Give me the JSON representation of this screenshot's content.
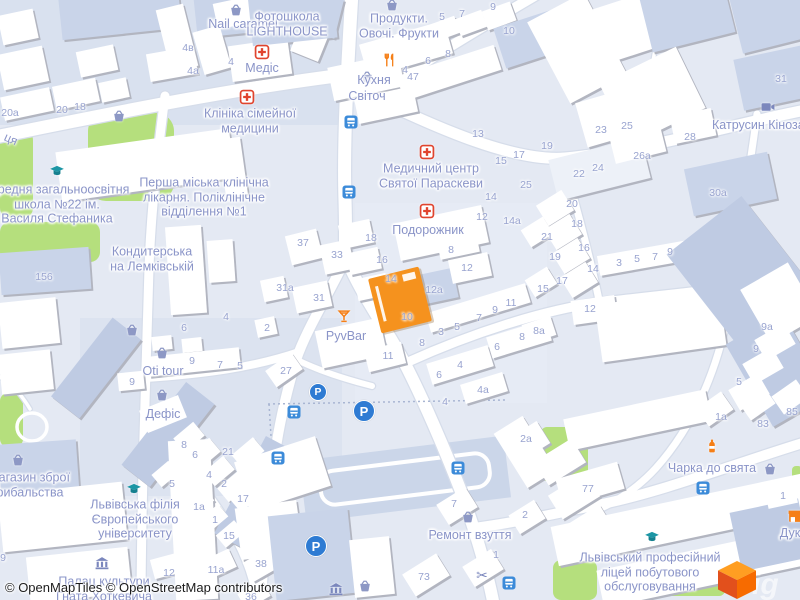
{
  "map": {
    "attribution": "© OpenMapTiles © OpenStreetMap contributors",
    "watermark_fragment": "ig",
    "logo": {
      "name": "MapTiler cube"
    },
    "parking_glyph": "P",
    "colors": {
      "background": "#E4E9F3",
      "road": "#FFFFFF",
      "park": "#B5DF7D",
      "building_white": "#FFFFFF",
      "building_blue": "#C9D4E9",
      "highlight_building": "#F5921E",
      "poi_label": "#8A94C8",
      "house_number": "#98A3CF",
      "medical_red": "#E0442E",
      "amenity_orange": "#F57F17",
      "education_teal": "#1C96A5",
      "transit_blue": "#3C8BD9",
      "parking_blue": "#2E7BD3"
    },
    "poi_labels": [
      {
        "text": "Nail caramel",
        "x": 243,
        "y": 24
      },
      {
        "text": "Фотошкола\nLIGHTHOUSE",
        "x": 287,
        "y": 24
      },
      {
        "text": "Продукти.\nОвочі. Фрукти",
        "x": 399,
        "y": 26
      },
      {
        "text": "Медіс",
        "x": 262,
        "y": 68
      },
      {
        "text": "Кухня",
        "x": 374,
        "y": 80
      },
      {
        "text": "Світоч",
        "x": 367,
        "y": 96
      },
      {
        "text": "Клініка сімейної\nмедицини",
        "x": 250,
        "y": 121
      },
      {
        "text": "Медичний центр\nСвятої Параскеви",
        "x": 431,
        "y": 176
      },
      {
        "text": "Подорожник",
        "x": 428,
        "y": 230
      },
      {
        "text": "Катрусин Кінозал",
        "x": 762,
        "y": 125
      },
      {
        "text": "середня загальноосвітня\nшкола №22 ім.\nВасиля Стефаника",
        "x": 57,
        "y": 204
      },
      {
        "text": "Перша міська клінічна\nлікарня. Поліклінічне\nвідділення №1",
        "x": 204,
        "y": 197
      },
      {
        "text": "Кондитерська\nна Лемківській",
        "x": 152,
        "y": 259
      },
      {
        "text": "PyvBar",
        "x": 346,
        "y": 336
      },
      {
        "text": "Oti tour",
        "x": 163,
        "y": 371
      },
      {
        "text": "Дефіс",
        "x": 163,
        "y": 414
      },
      {
        "text": "магазин зброї\nрибальства",
        "x": 30,
        "y": 485
      },
      {
        "text": "Львівська філія\nЄвропейського\nуніверситету",
        "x": 135,
        "y": 519
      },
      {
        "text": "Палац культури\nГната Хоткевича",
        "x": 104,
        "y": 589
      },
      {
        "text": "Ремонт взуття",
        "x": 470,
        "y": 535
      },
      {
        "text": "Чарка до свята",
        "x": 712,
        "y": 468
      },
      {
        "text": "Львівський професійний\nліцей побутового\nобслуговування",
        "x": 650,
        "y": 572
      },
      {
        "text": "Дук",
        "x": 790,
        "y": 533
      }
    ],
    "street_labels": [
      {
        "text": "ця",
        "x": 11,
        "y": 139,
        "rot": 24
      }
    ],
    "house_numbers": [
      [
        "4в",
        188,
        48
      ],
      [
        "4а",
        193,
        71
      ],
      [
        "4",
        231,
        62
      ],
      [
        "20а",
        10,
        113
      ],
      [
        "20",
        62,
        110
      ],
      [
        "18",
        80,
        107
      ],
      [
        "156",
        44,
        277
      ],
      [
        "5",
        442,
        17
      ],
      [
        "7",
        462,
        14
      ],
      [
        "9",
        493,
        7
      ],
      [
        "10",
        509,
        31
      ],
      [
        "4",
        405,
        70
      ],
      [
        "6",
        428,
        61
      ],
      [
        "8",
        448,
        54
      ],
      [
        "47",
        413,
        77
      ],
      [
        "13",
        478,
        134
      ],
      [
        "15",
        501,
        161
      ],
      [
        "17",
        519,
        155
      ],
      [
        "19",
        547,
        146
      ],
      [
        "25",
        526,
        185
      ],
      [
        "14",
        491,
        197
      ],
      [
        "12",
        482,
        217
      ],
      [
        "14а",
        512,
        221
      ],
      [
        "22",
        579,
        174
      ],
      [
        "24",
        598,
        168
      ],
      [
        "23",
        601,
        130
      ],
      [
        "25",
        627,
        126
      ],
      [
        "28",
        690,
        137
      ],
      [
        "26а",
        642,
        156
      ],
      [
        "30а",
        718,
        193
      ],
      [
        "31",
        781,
        79
      ],
      [
        "20",
        572,
        204
      ],
      [
        "18",
        577,
        224
      ],
      [
        "21",
        547,
        237
      ],
      [
        "16",
        584,
        248
      ],
      [
        "19",
        555,
        257
      ],
      [
        "14",
        593,
        269
      ],
      [
        "3",
        619,
        263
      ],
      [
        "5",
        637,
        259
      ],
      [
        "7",
        655,
        257
      ],
      [
        "9",
        670,
        252
      ],
      [
        "17",
        562,
        281
      ],
      [
        "15",
        543,
        289
      ],
      [
        "12",
        590,
        309
      ],
      [
        "8а",
        539,
        331
      ],
      [
        "9а",
        767,
        327
      ],
      [
        "9",
        756,
        349
      ],
      [
        "5",
        739,
        382
      ],
      [
        "37",
        303,
        243
      ],
      [
        "33",
        337,
        255
      ],
      [
        "18",
        371,
        238
      ],
      [
        "16",
        382,
        260
      ],
      [
        "14",
        391,
        279
      ],
      [
        "31а",
        285,
        288
      ],
      [
        "31",
        319,
        298
      ],
      [
        "12",
        467,
        268
      ],
      [
        "12а",
        434,
        290
      ],
      [
        "10",
        407,
        317
      ],
      [
        "11",
        511,
        303
      ],
      [
        "9",
        495,
        310
      ],
      [
        "7",
        479,
        318
      ],
      [
        "5",
        457,
        327
      ],
      [
        "3",
        441,
        332
      ],
      [
        "8",
        451,
        250
      ],
      [
        "8",
        422,
        343
      ],
      [
        "8",
        522,
        337
      ],
      [
        "6",
        497,
        347
      ],
      [
        "4",
        460,
        365
      ],
      [
        "6",
        439,
        375
      ],
      [
        "2",
        267,
        328
      ],
      [
        "27",
        286,
        371
      ],
      [
        "11",
        388,
        356
      ],
      [
        "4а",
        483,
        390
      ],
      [
        "4",
        226,
        317
      ],
      [
        "6",
        184,
        328
      ],
      [
        "9",
        192,
        361
      ],
      [
        "7",
        220,
        365
      ],
      [
        "5",
        240,
        366
      ],
      [
        "9",
        132,
        382
      ],
      [
        "8",
        184,
        445
      ],
      [
        "6",
        195,
        455
      ],
      [
        "21",
        228,
        452
      ],
      [
        "4",
        209,
        475
      ],
      [
        "2",
        224,
        484
      ],
      [
        "5",
        172,
        484
      ],
      [
        "17",
        243,
        499
      ],
      [
        "1а",
        199,
        507
      ],
      [
        "1",
        215,
        520
      ],
      [
        "15",
        229,
        536
      ],
      [
        "12",
        169,
        573
      ],
      [
        "11а",
        216,
        570
      ],
      [
        "38",
        261,
        564
      ],
      [
        "9",
        3,
        558
      ],
      [
        "36",
        251,
        597
      ],
      [
        "4",
        445,
        402
      ],
      [
        "2а",
        526,
        439
      ],
      [
        "7",
        454,
        504
      ],
      [
        "2",
        525,
        515
      ],
      [
        "1",
        496,
        555
      ],
      [
        "73",
        424,
        577
      ],
      [
        "1а",
        721,
        417
      ],
      [
        "83",
        763,
        424
      ],
      [
        "85",
        792,
        412
      ],
      [
        "77",
        588,
        489
      ],
      [
        "1",
        783,
        496
      ]
    ],
    "icons": [
      [
        "basket",
        236,
        10
      ],
      [
        "basket",
        392,
        5
      ],
      [
        "cross",
        262,
        52
      ],
      [
        "restaurant",
        390,
        60
      ],
      [
        "basket",
        367,
        77
      ],
      [
        "cross",
        247,
        97
      ],
      [
        "cross",
        427,
        152
      ],
      [
        "cross",
        427,
        211
      ],
      [
        "camera",
        768,
        107
      ],
      [
        "cap",
        57,
        171
      ],
      [
        "basket",
        119,
        116
      ],
      [
        "basket",
        132,
        330
      ],
      [
        "basket",
        162,
        353
      ],
      [
        "basket",
        162,
        395
      ],
      [
        "cocktail",
        344,
        316
      ],
      [
        "cap",
        134,
        489
      ],
      [
        "museum",
        102,
        563
      ],
      [
        "basket",
        18,
        460
      ],
      [
        "basket",
        468,
        517
      ],
      [
        "scissors",
        482,
        575
      ],
      [
        "bottle",
        712,
        446
      ],
      [
        "basket",
        770,
        469
      ],
      [
        "cap",
        652,
        537
      ],
      [
        "shop",
        795,
        516
      ],
      [
        "museum",
        336,
        589
      ],
      [
        "basket",
        365,
        586
      ]
    ],
    "bus_stops": [
      [
        351,
        122
      ],
      [
        349,
        192
      ],
      [
        294,
        412
      ],
      [
        278,
        458
      ],
      [
        458,
        468
      ],
      [
        509,
        583
      ],
      [
        703,
        488
      ]
    ],
    "parking": [
      [
        318,
        392,
        8
      ],
      [
        364,
        411,
        10
      ],
      [
        316,
        546,
        10
      ]
    ],
    "highlighted_building": {
      "x": 400,
      "y": 300,
      "w": 52,
      "h": 56,
      "rot": -14,
      "color": "#F5921E"
    }
  }
}
